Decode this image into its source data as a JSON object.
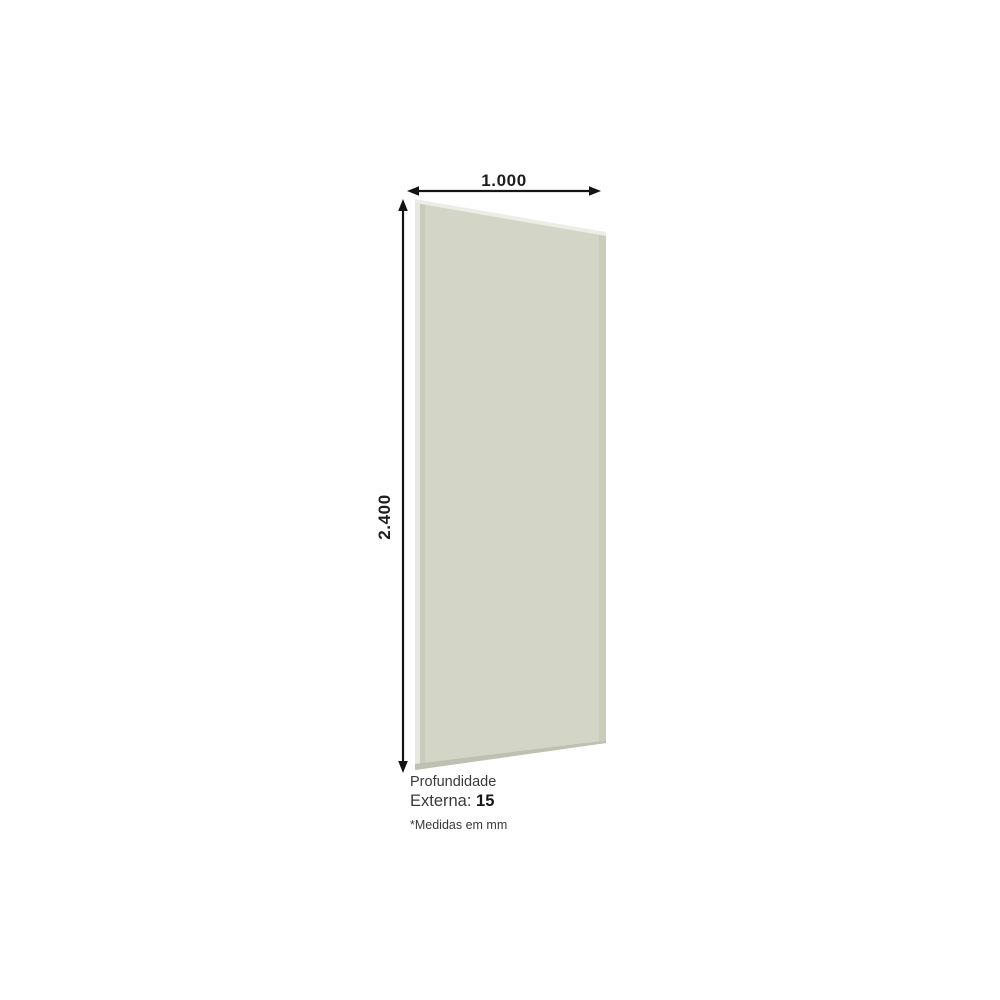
{
  "diagram": {
    "width_label": "1.000",
    "height_label": "2.400",
    "depth_title": "Profundidade",
    "depth_prefix": "Externa: ",
    "depth_value": "15",
    "footnote": "*Medidas em mm"
  },
  "colors": {
    "background": "#ffffff",
    "panel_face": "#d3d5c7",
    "panel_top_edge": "#eeede5",
    "panel_left_edge_highlight": "#e9e8e0",
    "panel_left_edge_shadow": "#c9cbbd",
    "panel_right_edge": "#cbcdbb",
    "panel_bottom_edge": "#bec0b1",
    "dimension_line": "#141414",
    "dimension_text": "#1d1d1b"
  }
}
